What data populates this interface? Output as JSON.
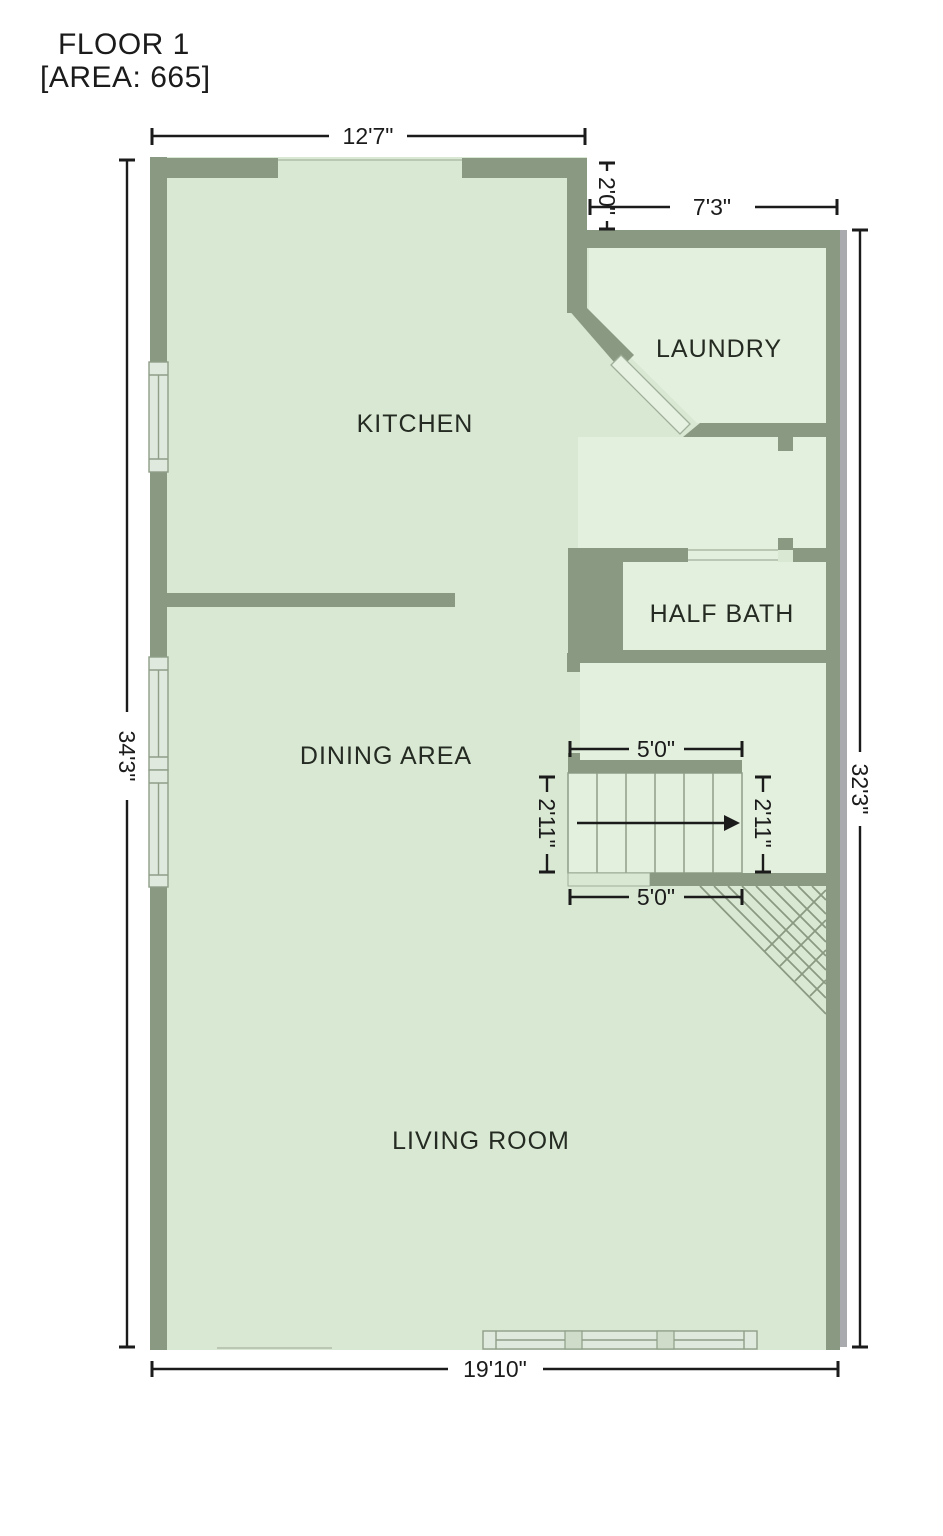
{
  "title": {
    "floor": "FLOOR 1",
    "area": "[AREA: 665]"
  },
  "rooms": {
    "kitchen": "KITCHEN",
    "laundry": "LAUNDRY",
    "half_bath": "HALF BATH",
    "dining": "DINING AREA",
    "living": "LIVING ROOM"
  },
  "dimensions": {
    "kitchen_top_width": "12'7\"",
    "wall_step": "2'0\"",
    "laundry_top_width": "7'3\"",
    "left_total_height": "34'3\"",
    "right_total_height": "32'3\"",
    "stairs_top_width": "5'0\"",
    "stairs_left_depth": "2'11\"",
    "stairs_right_depth": "2'11\"",
    "stairs_bottom_width": "5'0\"",
    "bottom_total_width": "19'10\""
  },
  "icons": {
    "stairs_direction": "right-arrow",
    "understair": "diagonal-crosshatch"
  },
  "colors": {
    "wall": "#8a9a82",
    "floor": "#d8e8d3",
    "room_highlight": "#e3f0de",
    "window_fill": "#dfe9dd",
    "window_frame": "#8e9e88",
    "wall_shadow": "#a9aaae",
    "dimension_text": "#1b1b1b",
    "background": "#ffffff"
  }
}
